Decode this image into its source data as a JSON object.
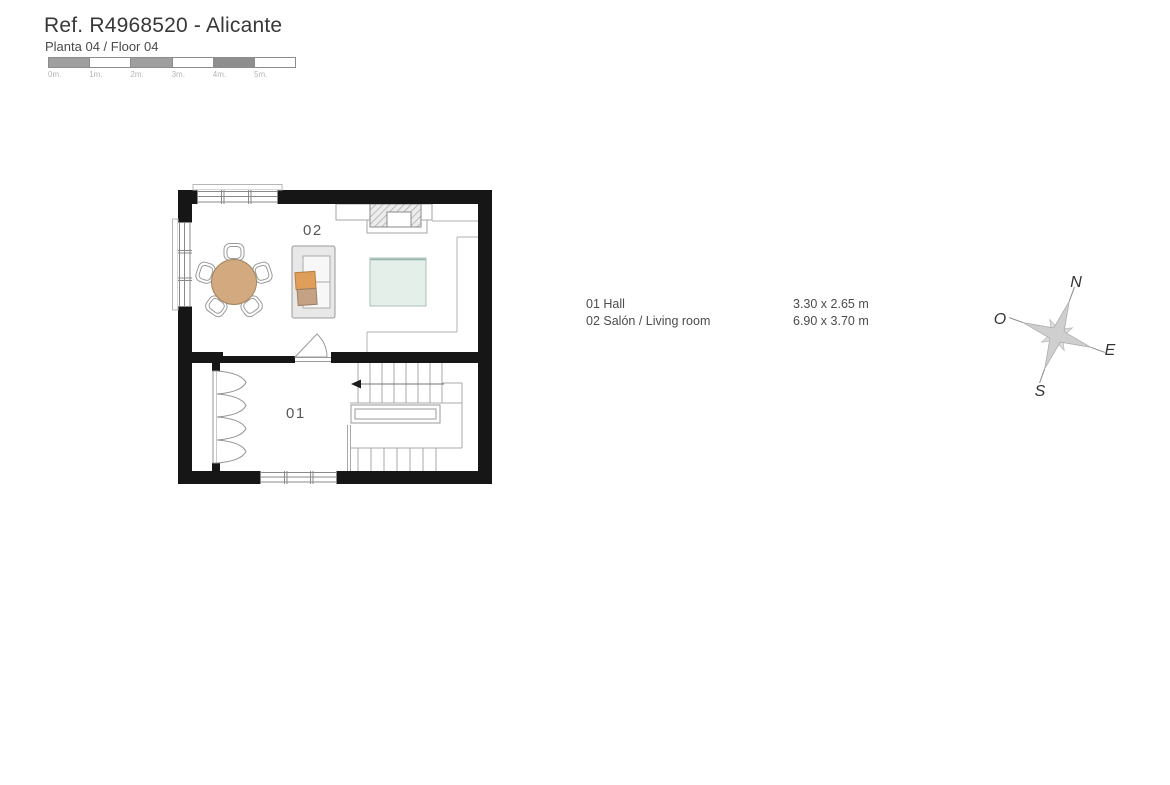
{
  "header": {
    "title": "Ref. R4968520 - Alicante",
    "subtitle": "Planta 04 / Floor 04"
  },
  "scale_bar": {
    "segments": [
      {
        "label": "0m.",
        "fill": "#9f9f9f"
      },
      {
        "label": "1m.",
        "fill": "#ffffff"
      },
      {
        "label": "2m.",
        "fill": "#9f9f9f"
      },
      {
        "label": "3m.",
        "fill": "#ffffff"
      },
      {
        "label": "4m.",
        "fill": "#8e8e8e"
      },
      {
        "label": "5m.",
        "fill": "#ffffff"
      }
    ]
  },
  "floor_plan": {
    "room_labels": {
      "hall": "01",
      "living": "02"
    }
  },
  "legend": {
    "rows": [
      {
        "label": "01 Hall",
        "size": "3.30 x 2.65 m"
      },
      {
        "label": "02 Salón / Living room",
        "size": "6.90 x 3.70 m"
      }
    ]
  },
  "compass": {
    "north": "N",
    "south": "S",
    "east": "E",
    "west": "O"
  },
  "colors": {
    "wall": "#161616",
    "thin_line": "#b0b0b0",
    "frame_line": "#8a8a8a",
    "table": "#d3a980",
    "table_border": "#a1855f",
    "cushion_orange": "#df9f5a",
    "cushion_tan": "#c5a284",
    "sofa": "#e8e8e8",
    "seat": "#f7f7f7",
    "rug": "#e4efe9",
    "rug_border": "#aebfba",
    "star": "#cfcfcf"
  }
}
